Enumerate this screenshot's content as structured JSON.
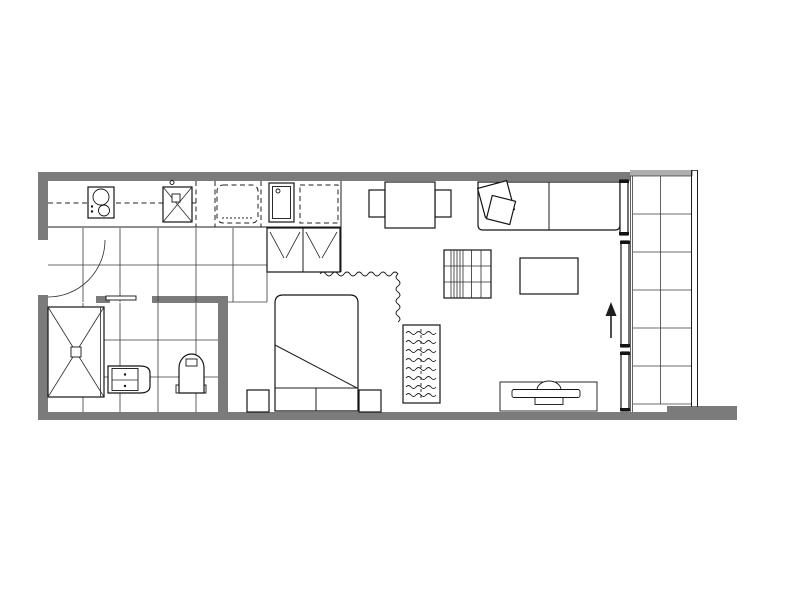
{
  "document": {
    "kind": "apartment-floor-plan",
    "background": "#ffffff",
    "canvas": {
      "width": 800,
      "height": 600
    }
  },
  "colors": {
    "wall": "#7b7b7b",
    "wall_light": "#aeaeae",
    "line": "#1e1e1e",
    "floor": "#ffffff"
  },
  "names": {
    "plan": "studio-apartment-floor-plan",
    "entry_door": "entry-door-swing",
    "kitchen": "kitchen",
    "counter": "kitchen-counter",
    "overhead": "overhead-cupboard-dashed-line",
    "cooktop": "cooktop-two-burners",
    "sink": "kitchen-sink",
    "fridge": "refrigerator-space-dashed",
    "tub": "laundry-tub",
    "appliance": "appliance-space-dashed",
    "cupboard": "double-door-cupboard",
    "kitchen_tiles": "kitchen-tiled-floor",
    "bathroom": "bathroom",
    "bath_tiles": "bathroom-tiled-floor",
    "shower": "shower-with-drain",
    "vanity": "vanity-with-basin",
    "toilet": "toilet",
    "bath_door": "bathroom-door-leaf",
    "bedroom": "bedroom",
    "bed": "double-bed",
    "pillows": "bed-pillows",
    "bedside_left": "bedside-table-left",
    "bedside_right": "bedside-table-right",
    "wardrobe": "open-wardrobe-hanging-rail",
    "curtain": "curtain-zigzag-divider",
    "living": "living-dining-area",
    "dining_table": "dining-table",
    "chair_left": "dining-chair-left",
    "chair_right": "dining-chair-right",
    "sofa": "two-seat-sofa",
    "cushions": "sofa-cushions",
    "shelf": "shelf-unit",
    "coffee_table": "coffee-table",
    "tv_unit": "tv-unit-with-tv",
    "sliding_door": "balcony-sliding-door",
    "entry_arrow": "balcony-access-arrow",
    "balcony": "balcony",
    "balustrade": "balcony-balustrade",
    "balcony_tiles": "balcony-tiled-floor"
  },
  "rooms": [
    {
      "id": "kitchen",
      "fixtures": [
        "cooktop-two-burners",
        "kitchen-sink",
        "refrigerator-space-dashed",
        "laundry-tub",
        "appliance-space-dashed",
        "double-door-cupboard",
        "tiled-floor"
      ]
    },
    {
      "id": "bathroom",
      "fixtures": [
        "shower-with-drain",
        "vanity-with-basin",
        "toilet",
        "tiled-floor"
      ]
    },
    {
      "id": "bedroom",
      "fixtures": [
        "double-bed",
        "bedside-table-left",
        "bedside-table-right",
        "open-wardrobe-hanging-rail",
        "curtain-zigzag-divider"
      ]
    },
    {
      "id": "living-dining",
      "fixtures": [
        "dining-table",
        "dining-chair-left",
        "dining-chair-right",
        "two-seat-sofa",
        "sofa-cushions",
        "shelf-unit",
        "coffee-table",
        "tv-unit-with-tv"
      ]
    },
    {
      "id": "balcony",
      "fixtures": [
        "sliding-door-three-panels",
        "balustrade",
        "tiled-floor",
        "access-arrow"
      ]
    }
  ]
}
